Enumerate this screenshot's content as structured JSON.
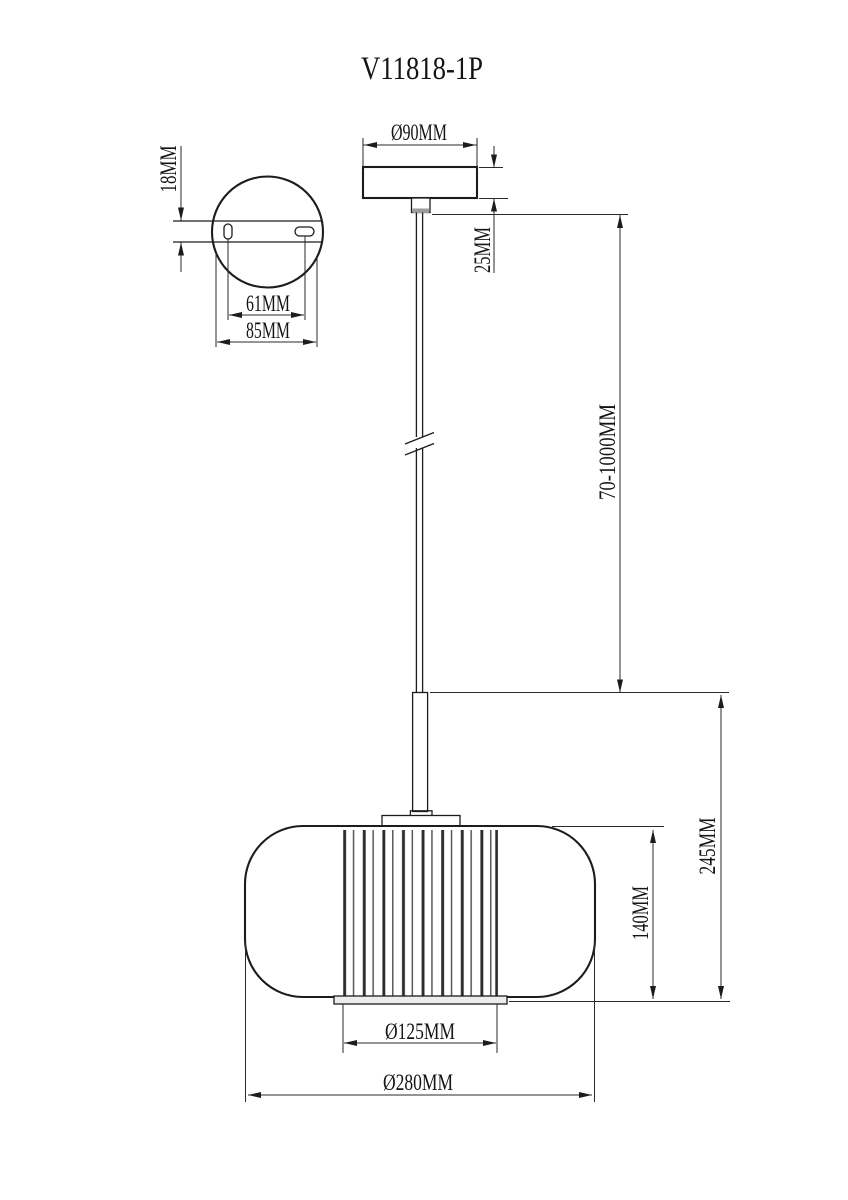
{
  "title": "V11818-1P",
  "colors": {
    "paper": "#ffffff",
    "ink": "#1c1c1c"
  },
  "views": {
    "mount_plate_top": {
      "labels": {
        "thickness": "18MM",
        "hole_spacing": "61MM",
        "plate_width": "85MM"
      }
    },
    "canopy_front": {
      "labels": {
        "diameter": "Ø90MM",
        "height": "25MM"
      }
    },
    "rod": {
      "labels": {
        "length_range": "70-1000MM"
      }
    },
    "shade_front": {
      "labels": {
        "diffuser_height": "140MM",
        "body_height": "245MM",
        "diffuser_diameter": "Ø125MM",
        "shade_diameter": "Ø280MM"
      }
    }
  }
}
